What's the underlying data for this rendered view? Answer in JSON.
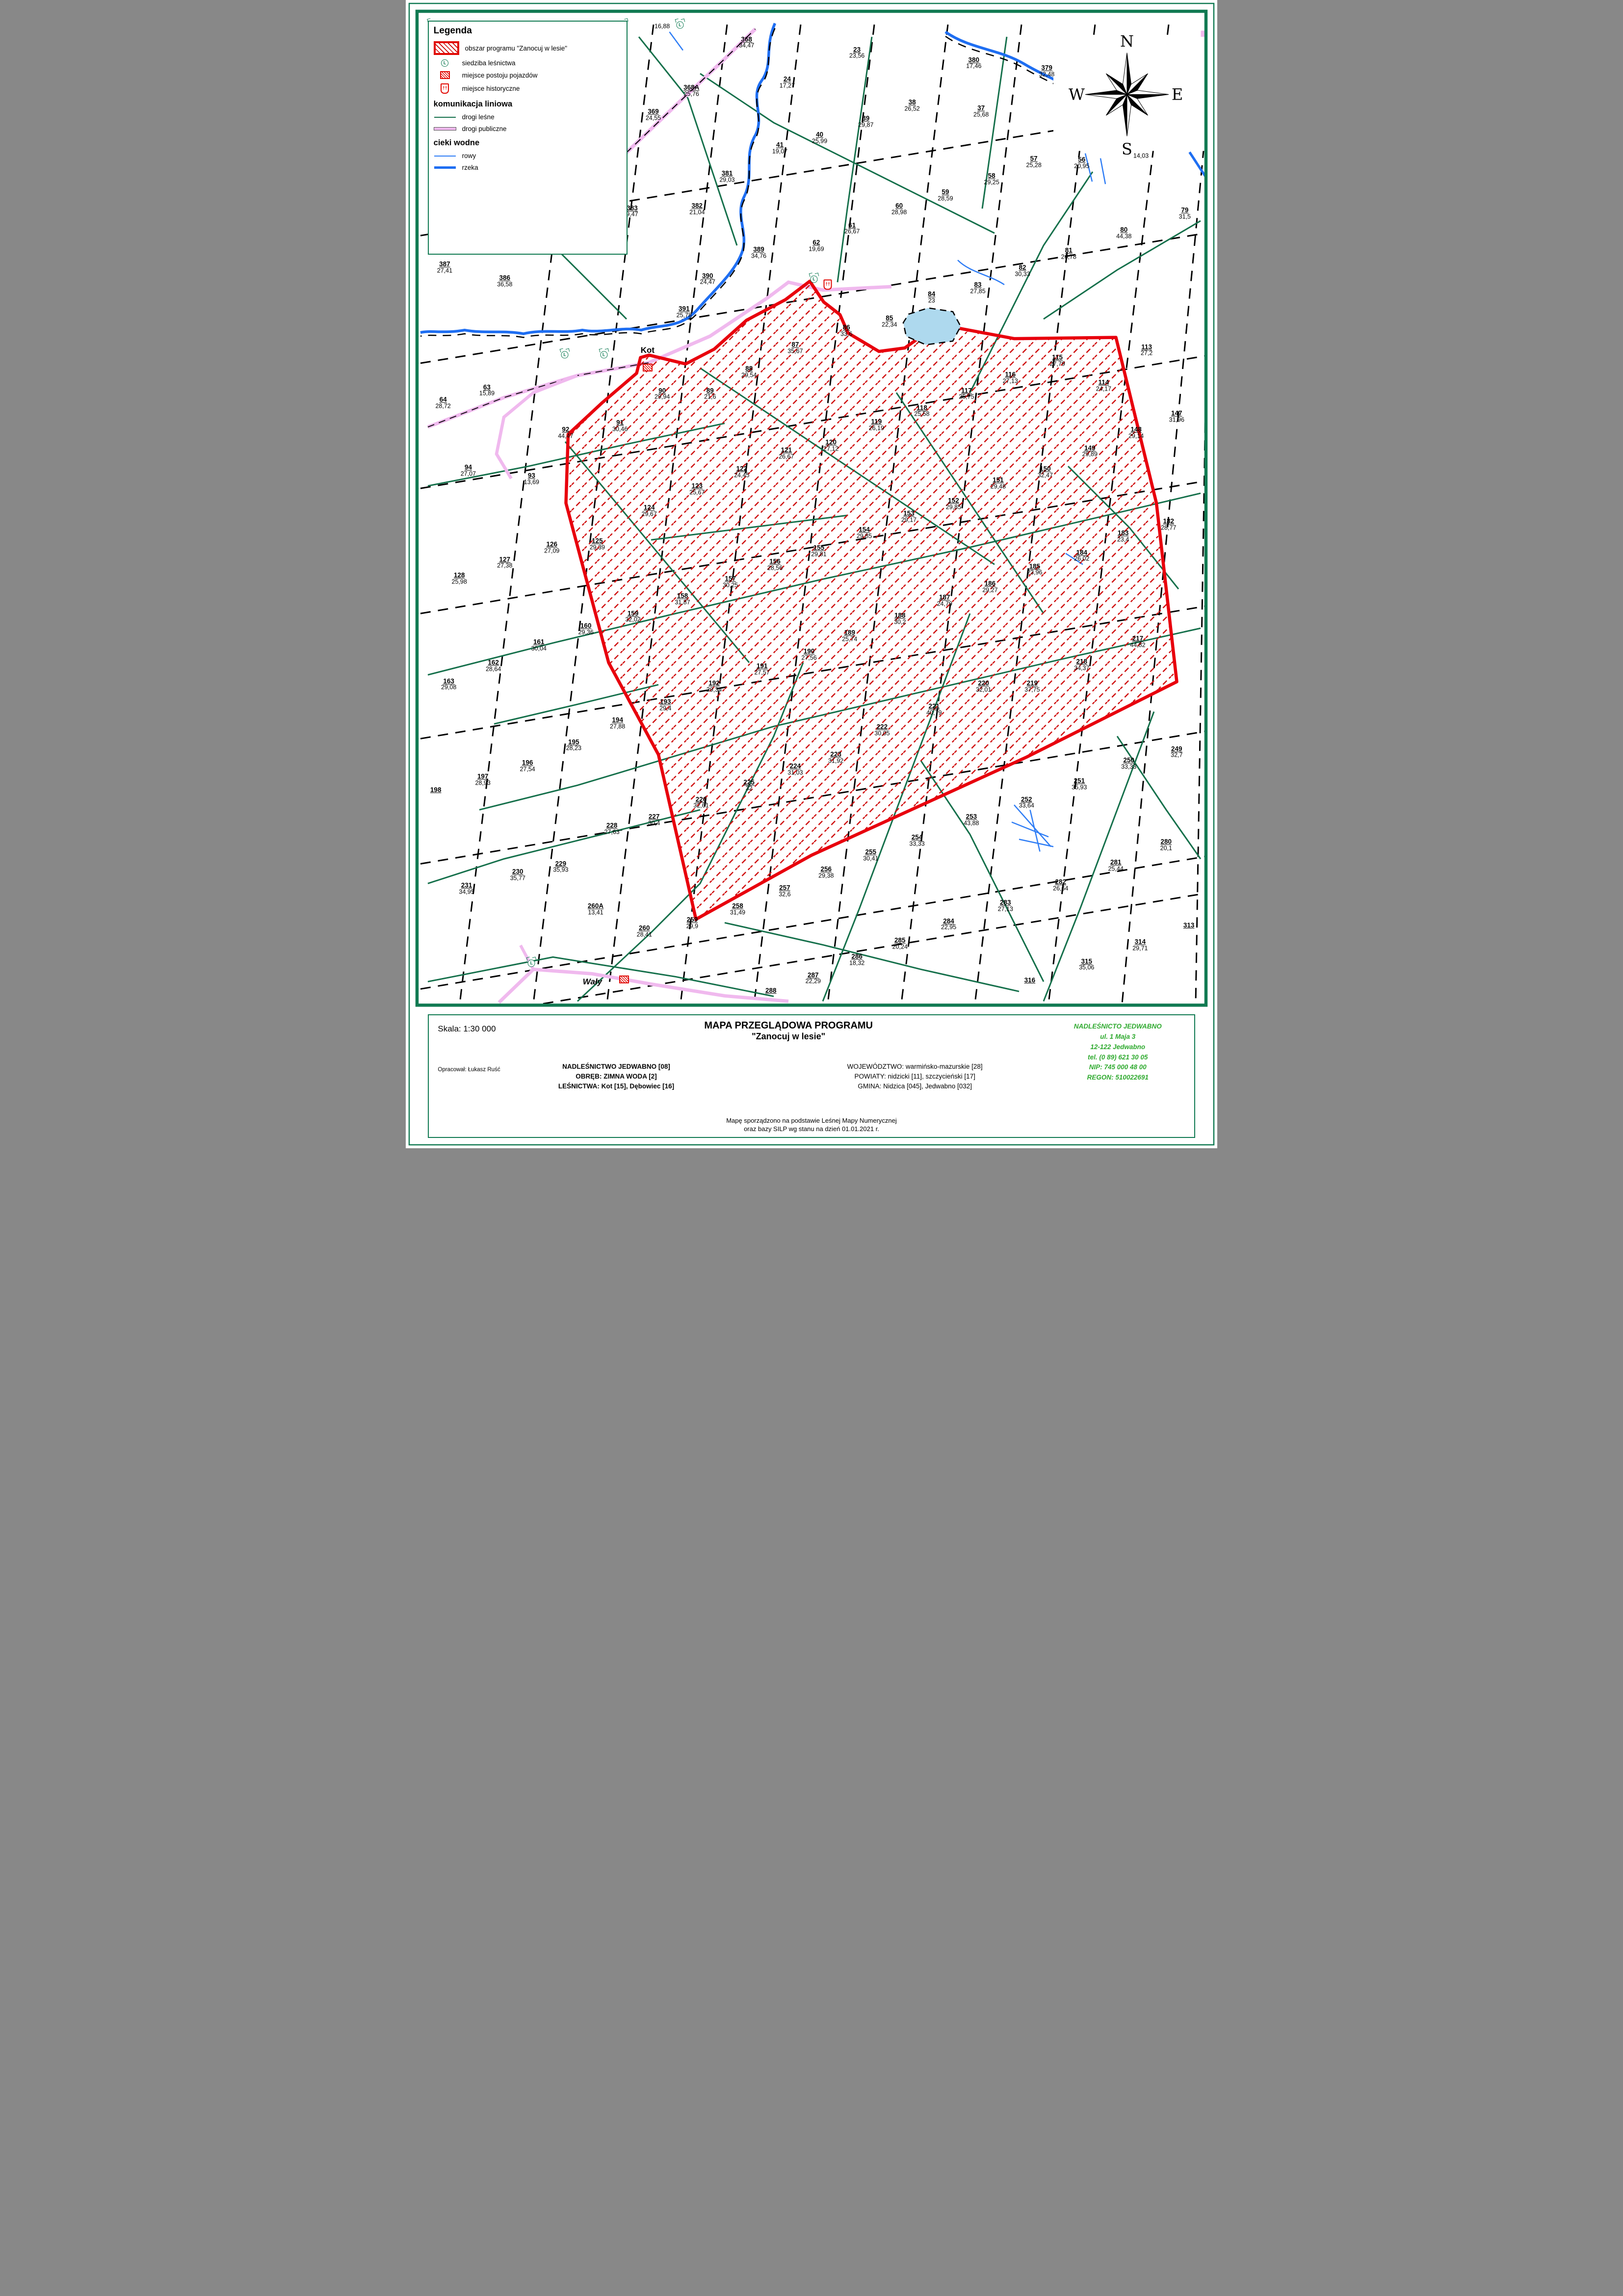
{
  "legend": {
    "title": "Legenda",
    "items": [
      {
        "label": "obszar programu \"Zanocuj w lesie\""
      },
      {
        "label": "siedziba leśnictwa"
      },
      {
        "label": "miejsce postoju pojazdów"
      },
      {
        "label": "miejsce historyczne"
      }
    ],
    "section_lines": "komunikacja liniowa",
    "line_items": [
      {
        "label": "drogi leśne"
      },
      {
        "label": "drogi publiczne"
      }
    ],
    "section_water": "cieki wodne",
    "water_items": [
      {
        "label": "rowy"
      },
      {
        "label": "rzeka"
      }
    ]
  },
  "compass": {
    "n": "N",
    "e": "E",
    "s": "S",
    "w": "W"
  },
  "place_labels": [
    {
      "text": "Kot",
      "x": 29.8,
      "y": 30.5,
      "italic": false
    },
    {
      "text": "Wały",
      "x": 23.0,
      "y": 85.5,
      "italic": true
    }
  ],
  "icons": {
    "lesnictwo": [
      [
        33.8,
        2.2
      ],
      [
        19.6,
        30.9
      ],
      [
        24.4,
        30.9
      ],
      [
        50.3,
        24.3
      ],
      [
        15.5,
        83.9
      ]
    ],
    "parking": [
      [
        29.8,
        32.0
      ],
      [
        26.9,
        85.3
      ]
    ],
    "historic": [
      [
        52.0,
        24.8
      ]
    ]
  },
  "compartments": [
    {
      "n": "",
      "a": "16,88",
      "x": 31.6,
      "y": 2.3
    },
    {
      "n": "368",
      "a": "34,47",
      "x": 42.0,
      "y": 3.7
    },
    {
      "n": "23",
      "a": "23,56",
      "x": 55.6,
      "y": 4.6
    },
    {
      "n": "24",
      "a": "17,27",
      "x": 47.0,
      "y": 7.2
    },
    {
      "n": "380",
      "a": "17,46",
      "x": 70.0,
      "y": 5.5
    },
    {
      "n": "379",
      "a": "32,48",
      "x": 79.0,
      "y": 6.2
    },
    {
      "n": "368A",
      "a": "25,76",
      "x": 35.2,
      "y": 7.9
    },
    {
      "n": "369",
      "a": "24,55",
      "x": 30.5,
      "y": 10.0
    },
    {
      "n": "38",
      "a": "26,52",
      "x": 62.4,
      "y": 9.2
    },
    {
      "n": "37",
      "a": "25,68",
      "x": 70.9,
      "y": 9.7
    },
    {
      "n": "39",
      "a": "29,87",
      "x": 56.7,
      "y": 10.6
    },
    {
      "n": "40",
      "a": "25,99",
      "x": 51.0,
      "y": 12.0
    },
    {
      "n": "41",
      "a": "19,07",
      "x": 46.1,
      "y": 12.9
    },
    {
      "n": "57",
      "a": "25,28",
      "x": 77.4,
      "y": 14.1
    },
    {
      "n": "56",
      "a": "20,95",
      "x": 83.3,
      "y": 14.2
    },
    {
      "n": "",
      "a": "14,03",
      "x": 90.6,
      "y": 13.6
    },
    {
      "n": "58",
      "a": "29,25",
      "x": 72.2,
      "y": 15.6
    },
    {
      "n": "59",
      "a": "28,59",
      "x": 66.5,
      "y": 17.0
    },
    {
      "n": "60",
      "a": "28,98",
      "x": 60.8,
      "y": 18.2
    },
    {
      "n": "61",
      "a": "26,67",
      "x": 55.0,
      "y": 19.9
    },
    {
      "n": "62",
      "a": "19,69",
      "x": 50.6,
      "y": 21.4
    },
    {
      "n": "79",
      "a": "31,5",
      "x": 96.0,
      "y": 18.6
    },
    {
      "n": "80",
      "a": "44,38",
      "x": 88.5,
      "y": 20.3
    },
    {
      "n": "81",
      "a": "26,78",
      "x": 81.7,
      "y": 22.1
    },
    {
      "n": "381",
      "a": "29,03",
      "x": 39.6,
      "y": 15.4
    },
    {
      "n": "382",
      "a": "21,04",
      "x": 35.9,
      "y": 18.2
    },
    {
      "n": "383",
      "a": "9,47",
      "x": 27.9,
      "y": 18.4
    },
    {
      "n": "389",
      "a": "34,76",
      "x": 43.5,
      "y": 22.0
    },
    {
      "n": "387",
      "a": "27,41",
      "x": 4.8,
      "y": 23.3
    },
    {
      "n": "386",
      "a": "36,58",
      "x": 12.2,
      "y": 24.5
    },
    {
      "n": "390",
      "a": "24,47",
      "x": 37.2,
      "y": 24.3
    },
    {
      "n": "391",
      "a": "25,78",
      "x": 34.3,
      "y": 27.2
    },
    {
      "n": "82",
      "a": "30,33",
      "x": 76.0,
      "y": 23.6
    },
    {
      "n": "83",
      "a": "27,85",
      "x": 70.5,
      "y": 25.1
    },
    {
      "n": "84",
      "a": "23",
      "x": 64.8,
      "y": 25.9
    },
    {
      "n": "85",
      "a": "22,34",
      "x": 59.6,
      "y": 28.0
    },
    {
      "n": "86",
      "a": "33,6",
      "x": 54.3,
      "y": 28.8
    },
    {
      "n": "87",
      "a": "35,67",
      "x": 48.0,
      "y": 30.3
    },
    {
      "n": "88",
      "a": "29,54",
      "x": 42.3,
      "y": 32.4
    },
    {
      "n": "89",
      "a": "21,6",
      "x": 37.5,
      "y": 34.3
    },
    {
      "n": "90",
      "a": "29,94",
      "x": 31.6,
      "y": 34.3
    },
    {
      "n": "91",
      "a": "30,46",
      "x": 26.4,
      "y": 37.1
    },
    {
      "n": "92",
      "a": "44,47",
      "x": 19.7,
      "y": 37.7
    },
    {
      "n": "63",
      "a": "15,89",
      "x": 10.0,
      "y": 34.0
    },
    {
      "n": "64",
      "a": "28,72",
      "x": 4.6,
      "y": 35.1
    },
    {
      "n": "94",
      "a": "27,07",
      "x": 7.7,
      "y": 41.0
    },
    {
      "n": "93",
      "a": "13,69",
      "x": 15.5,
      "y": 41.7
    },
    {
      "n": "113",
      "a": "27,2",
      "x": 91.3,
      "y": 30.5
    },
    {
      "n": "114",
      "a": "24,17",
      "x": 86.0,
      "y": 33.6
    },
    {
      "n": "115",
      "a": "27,79",
      "x": 80.3,
      "y": 31.4
    },
    {
      "n": "116",
      "a": "27,13",
      "x": 74.5,
      "y": 32.9
    },
    {
      "n": "117",
      "a": "25,75",
      "x": 69.1,
      "y": 34.3
    },
    {
      "n": "118",
      "a": "25,58",
      "x": 63.6,
      "y": 35.8
    },
    {
      "n": "119",
      "a": "26,19",
      "x": 58.0,
      "y": 37.0
    },
    {
      "n": "120",
      "a": "27,12",
      "x": 52.4,
      "y": 38.8
    },
    {
      "n": "121",
      "a": "26,67",
      "x": 46.9,
      "y": 39.5
    },
    {
      "n": "122",
      "a": "24,45",
      "x": 41.4,
      "y": 41.1
    },
    {
      "n": "123",
      "a": "25,67",
      "x": 35.9,
      "y": 42.6
    },
    {
      "n": "124",
      "a": "29,67",
      "x": 30.0,
      "y": 44.5
    },
    {
      "n": "125",
      "a": "29,39",
      "x": 23.6,
      "y": 47.4
    },
    {
      "n": "147",
      "a": "31,96",
      "x": 95.0,
      "y": 36.3
    },
    {
      "n": "148",
      "a": "29,14",
      "x": 90.0,
      "y": 37.7
    },
    {
      "n": "149",
      "a": "29,89",
      "x": 84.3,
      "y": 39.3
    },
    {
      "n": "150",
      "a": "32,47",
      "x": 78.8,
      "y": 41.1
    },
    {
      "n": "151",
      "a": "29,48",
      "x": 73.0,
      "y": 42.1
    },
    {
      "n": "152",
      "a": "29,85",
      "x": 67.5,
      "y": 43.9
    },
    {
      "n": "153",
      "a": "29,17",
      "x": 62.0,
      "y": 45.0
    },
    {
      "n": "154",
      "a": "29,85",
      "x": 56.5,
      "y": 46.4
    },
    {
      "n": "155",
      "a": "29,81",
      "x": 50.9,
      "y": 48.0
    },
    {
      "n": "126",
      "a": "27,09",
      "x": 18.0,
      "y": 47.7
    },
    {
      "n": "127",
      "a": "27,38",
      "x": 12.2,
      "y": 49.0
    },
    {
      "n": "128",
      "a": "25,98",
      "x": 6.6,
      "y": 50.4
    },
    {
      "n": "156",
      "a": "28,56",
      "x": 45.5,
      "y": 49.2
    },
    {
      "n": "157",
      "a": "30,25",
      "x": 40.0,
      "y": 50.7
    },
    {
      "n": "158",
      "a": "31,87",
      "x": 34.1,
      "y": 52.2
    },
    {
      "n": "159",
      "a": "32,02",
      "x": 28.0,
      "y": 53.7
    },
    {
      "n": "160",
      "a": "29,36",
      "x": 22.2,
      "y": 54.8
    },
    {
      "n": "161",
      "a": "30,04",
      "x": 16.4,
      "y": 56.2
    },
    {
      "n": "162",
      "a": "28,64",
      "x": 10.8,
      "y": 58.0
    },
    {
      "n": "163",
      "a": "29,08",
      "x": 5.3,
      "y": 59.6
    },
    {
      "n": "182",
      "a": "28,77",
      "x": 94.0,
      "y": 45.7
    },
    {
      "n": "183",
      "a": "23,4",
      "x": 88.4,
      "y": 46.7
    },
    {
      "n": "184",
      "a": "26,02",
      "x": 83.3,
      "y": 48.4
    },
    {
      "n": "185",
      "a": "23,96",
      "x": 77.5,
      "y": 49.6
    },
    {
      "n": "186",
      "a": "29,27",
      "x": 72.0,
      "y": 51.1
    },
    {
      "n": "187",
      "a": "24,79",
      "x": 66.4,
      "y": 52.3
    },
    {
      "n": "188",
      "a": "30,2",
      "x": 60.9,
      "y": 53.9
    },
    {
      "n": "189",
      "a": "25,74",
      "x": 54.7,
      "y": 55.4
    },
    {
      "n": "190",
      "a": "27,56",
      "x": 49.7,
      "y": 57.0
    },
    {
      "n": "191",
      "a": "27,57",
      "x": 43.9,
      "y": 58.3
    },
    {
      "n": "192",
      "a": "29,34",
      "x": 38.0,
      "y": 59.8
    },
    {
      "n": "193",
      "a": "29,4",
      "x": 32.0,
      "y": 61.4
    },
    {
      "n": "194",
      "a": "27,88",
      "x": 26.1,
      "y": 63.0
    },
    {
      "n": "195",
      "a": "28,23",
      "x": 20.7,
      "y": 64.9
    },
    {
      "n": "196",
      "a": "27,54",
      "x": 15.0,
      "y": 66.7
    },
    {
      "n": "197",
      "a": "28,93",
      "x": 9.5,
      "y": 67.9
    },
    {
      "n": "198",
      "a": "",
      "x": 3.7,
      "y": 68.8
    },
    {
      "n": "217",
      "a": "44,82",
      "x": 90.2,
      "y": 55.9
    },
    {
      "n": "218",
      "a": "34,37",
      "x": 83.3,
      "y": 57.9
    },
    {
      "n": "219",
      "a": "37,75",
      "x": 77.2,
      "y": 59.8
    },
    {
      "n": "220",
      "a": "32,01",
      "x": 71.2,
      "y": 59.8
    },
    {
      "n": "221",
      "a": "40,79",
      "x": 65.1,
      "y": 61.8
    },
    {
      "n": "222",
      "a": "30,05",
      "x": 58.7,
      "y": 63.6
    },
    {
      "n": "223",
      "a": "31,92",
      "x": 53.0,
      "y": 66.0
    },
    {
      "n": "224",
      "a": "31,03",
      "x": 48.0,
      "y": 67.0
    },
    {
      "n": "225",
      "a": "32",
      "x": 42.3,
      "y": 68.4
    },
    {
      "n": "226",
      "a": "32,61",
      "x": 36.4,
      "y": 69.9
    },
    {
      "n": "227",
      "a": "30,4",
      "x": 30.6,
      "y": 71.4
    },
    {
      "n": "228",
      "a": "27,63",
      "x": 25.4,
      "y": 72.2
    },
    {
      "n": "229",
      "a": "35,93",
      "x": 19.1,
      "y": 75.5
    },
    {
      "n": "230",
      "a": "35,77",
      "x": 13.8,
      "y": 76.2
    },
    {
      "n": "231",
      "a": "34,95",
      "x": 7.5,
      "y": 77.4
    },
    {
      "n": "249",
      "a": "32,7",
      "x": 95.0,
      "y": 65.5
    },
    {
      "n": "250",
      "a": "33,33",
      "x": 89.1,
      "y": 66.5
    },
    {
      "n": "251",
      "a": "35,93",
      "x": 83.0,
      "y": 68.3
    },
    {
      "n": "252",
      "a": "33,64",
      "x": 76.5,
      "y": 69.9
    },
    {
      "n": "253",
      "a": "43,88",
      "x": 69.7,
      "y": 71.4
    },
    {
      "n": "254",
      "a": "33,33",
      "x": 63.0,
      "y": 73.2
    },
    {
      "n": "255",
      "a": "30,41",
      "x": 57.3,
      "y": 74.5
    },
    {
      "n": "256",
      "a": "29,38",
      "x": 51.8,
      "y": 76.0
    },
    {
      "n": "257",
      "a": "32,6",
      "x": 46.7,
      "y": 77.6
    },
    {
      "n": "258",
      "a": "31,49",
      "x": 40.9,
      "y": 79.2
    },
    {
      "n": "259",
      "a": "29,9",
      "x": 35.3,
      "y": 80.4
    },
    {
      "n": "260",
      "a": "28,41",
      "x": 29.4,
      "y": 81.1
    },
    {
      "n": "260A",
      "a": "13,41",
      "x": 23.4,
      "y": 79.2
    },
    {
      "n": "280",
      "a": "20,1",
      "x": 93.7,
      "y": 73.6
    },
    {
      "n": "281",
      "a": "25,44",
      "x": 87.5,
      "y": 75.4
    },
    {
      "n": "282",
      "a": "26,64",
      "x": 80.7,
      "y": 77.1
    },
    {
      "n": "283",
      "a": "27,13",
      "x": 73.9,
      "y": 78.9
    },
    {
      "n": "284",
      "a": "22,95",
      "x": 66.9,
      "y": 80.5
    },
    {
      "n": "285",
      "a": "20,24",
      "x": 60.9,
      "y": 82.2
    },
    {
      "n": "286",
      "a": "18,32",
      "x": 55.6,
      "y": 83.6
    },
    {
      "n": "287",
      "a": "22,29",
      "x": 50.2,
      "y": 85.2
    },
    {
      "n": "288",
      "a": "",
      "x": 45.0,
      "y": 86.3
    },
    {
      "n": "313",
      "a": "",
      "x": 96.5,
      "y": 80.6
    },
    {
      "n": "314",
      "a": "29,71",
      "x": 90.5,
      "y": 82.3
    },
    {
      "n": "315",
      "a": "35,06",
      "x": 83.9,
      "y": 84.0
    },
    {
      "n": "316",
      "a": "",
      "x": 76.9,
      "y": 85.4
    }
  ],
  "footer": {
    "skala": "Skala:  1:30 000",
    "opracowal": "Opracował: Łukasz Ruść",
    "title1": "MAPA PRZEGLĄDOWA PROGRAMU",
    "title2": "\"Zanocuj w lesie\"",
    "nadlesnictwo": "NADLEŚNICTWO JEDWABNO [08]",
    "obreb": "OBRĘB: ZIMNA WODA [2]",
    "lesnictwa": "LEŚNICTWA: Kot [15], Dębowiec [16]",
    "wojewodztwo": "WOJEWÓDZTWO: warmińsko-mazurskie [28]",
    "powiaty": "POWIATY: nidzicki [11], szczycieński [17]",
    "gmina": "GMINA: Nidzica [045], Jedwabno [032]",
    "green1": "NADLEŚNICTO JEDWABNO",
    "green2": "ul. 1 Maja 3",
    "green3": "12-122 Jedwabno",
    "green4": "tel. (0 89) 621 30 05",
    "green5": "NIP: 745 000 48 00",
    "green6": "REGON: 510022691",
    "note1": "Mapę sporządzono na podstawie Leśnej Mapy Numerycznej",
    "note2": "oraz bazy SILP wg stanu na dzień 01.01.2021 r."
  }
}
